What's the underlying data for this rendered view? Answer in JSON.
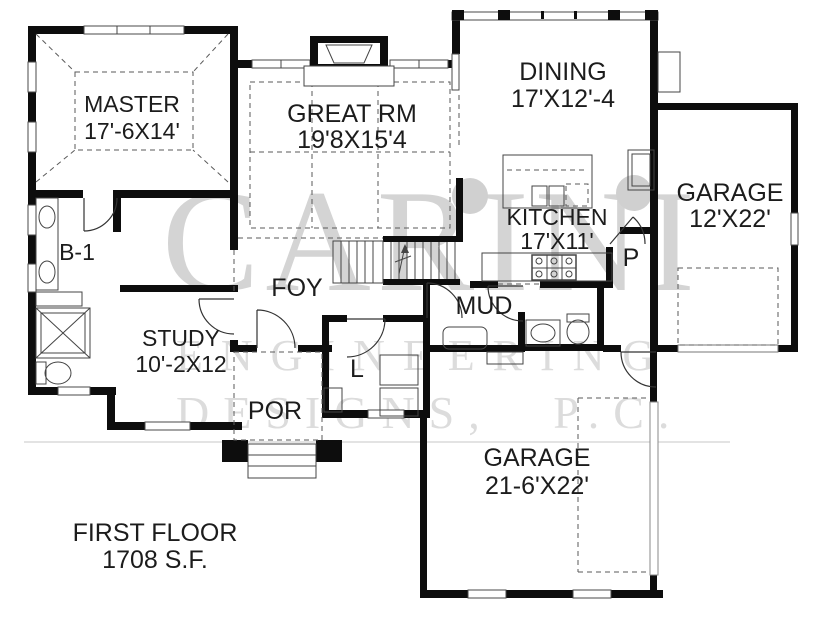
{
  "plan": {
    "title_line1": "FIRST FLOOR",
    "title_line2": "1708 S.F.",
    "rooms": {
      "master": {
        "name": "MASTER",
        "dims": "17'-6X14'"
      },
      "great": {
        "name": "GREAT RM",
        "dims": "19'8X15'4"
      },
      "dining": {
        "name": "DINING",
        "dims": "17'X12'-4"
      },
      "kitchen": {
        "name": "KITCHEN",
        "dims": "17'X11'"
      },
      "garage_right": {
        "name": "GARAGE",
        "dims": "12'X22'"
      },
      "garage_bottom": {
        "name": "GARAGE",
        "dims": "21-6'X22'"
      },
      "study": {
        "name": "STUDY",
        "dims": "10'-2X12"
      },
      "bath1": {
        "name": "B-1"
      },
      "foyer": {
        "name": "FOY"
      },
      "mud": {
        "name": "MUD"
      },
      "porch": {
        "name": "POR"
      },
      "laundry": {
        "name": "L"
      },
      "pantry": {
        "name": "P"
      }
    }
  },
  "watermark": {
    "line1": "CARINI",
    "line2": "ENGINEERING",
    "line3": "DESIGNS, P.C."
  },
  "colors": {
    "wall": "#0d0d0d",
    "label": "#1c1c1c",
    "watermark": "#d6d6d6",
    "background": "#ffffff"
  }
}
